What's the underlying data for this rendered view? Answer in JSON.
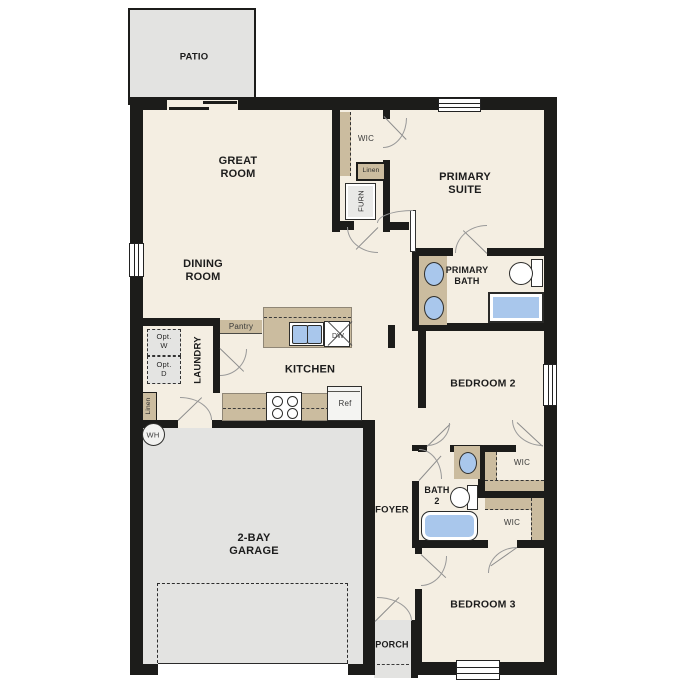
{
  "plan": {
    "labels": {
      "patio": "PATIO",
      "great_room": "GREAT\nROOM",
      "wic_primary": "WIC",
      "linen_hall": "Linen",
      "furnace": "FURN",
      "primary_suite": "PRIMARY\nSUITE",
      "dining_room": "DINING\nROOM",
      "primary_bath": "PRIMARY\nBATH",
      "pantry": "Pantry",
      "opt_washer": "Opt.\nW",
      "opt_dryer": "Opt.\nD",
      "laundry": "LAUNDRY",
      "linen_laundry": "Linen",
      "kitchen": "KITCHEN",
      "dishwasher": "DW",
      "refrigerator": "Ref",
      "water_heater": "WH",
      "bedroom_2": "BEDROOM 2",
      "wic_bedroom_2": "WIC",
      "bath_2": "BATH\n2",
      "foyer": "FOYER",
      "wic_bedroom_3": "WIC",
      "garage": "2-BAY\nGARAGE",
      "bedroom_3": "BEDROOM 3",
      "porch": "PORCH"
    },
    "colors": {
      "wall": "#1c1c1a",
      "floor": "#f4eee2",
      "concrete": "#e3e3e1",
      "cabinet_tan": "#cbbc9f",
      "fixture_blue": "#a9c7ec",
      "door_swing": "#8c8c8c"
    }
  }
}
